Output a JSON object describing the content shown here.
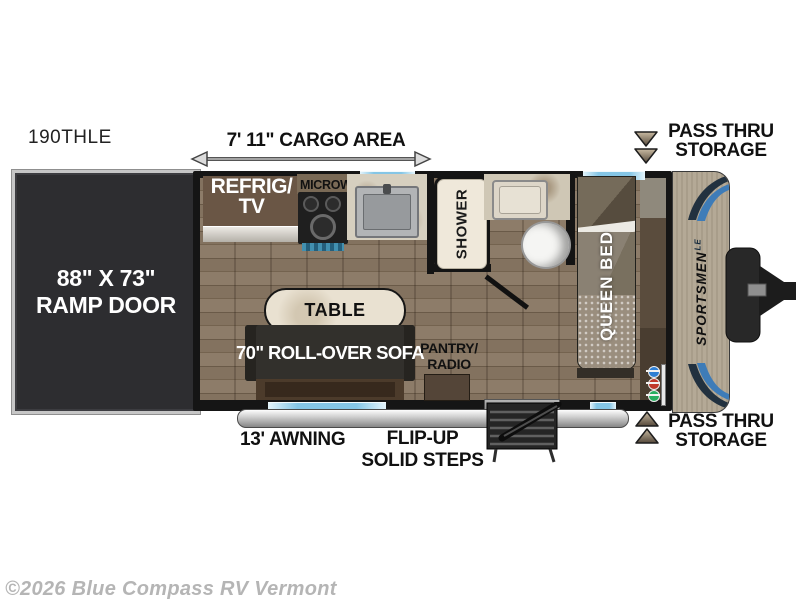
{
  "model": "190THLE",
  "copyright": "©2026 Blue Compass RV Vermont",
  "labels": {
    "cargo_area": "7' 11\" CARGO AREA",
    "ramp_door_size": "88\" X 73\"",
    "ramp_door": "RAMP DOOR",
    "refrig": "REFRIG/",
    "tv": "TV",
    "microwave": "MICROWAVE",
    "shower": "SHOWER",
    "table": "TABLE",
    "sofa": "70\" ROLL-OVER SOFA",
    "pantry": "PANTRY/",
    "radio": "RADIO",
    "queen_bed": "QUEEN BED",
    "awning": "13' AWNING",
    "steps_line1": "FLIP-UP",
    "steps_line2": "SOLID STEPS",
    "pass_thru": "PASS THRU",
    "storage": "STORAGE"
  },
  "brand": {
    "name": "SPORTSMEN",
    "trim": "LE"
  },
  "colors": {
    "wall": "#151515",
    "floor_wood": "#84735f",
    "ramp_door": "#2d2d30",
    "window_glass": "#85c6e6",
    "cabinet_brown": "#6a5645",
    "counter_marble": "#d6cfbf",
    "sofa_dark": "#32302c",
    "table_top": "#e9e1d1",
    "bed_blanket": "#847b6d",
    "cap_beige": "#b2a795",
    "accent_blue": "#3e7cb8",
    "hitch_black": "#2a2a2a"
  }
}
